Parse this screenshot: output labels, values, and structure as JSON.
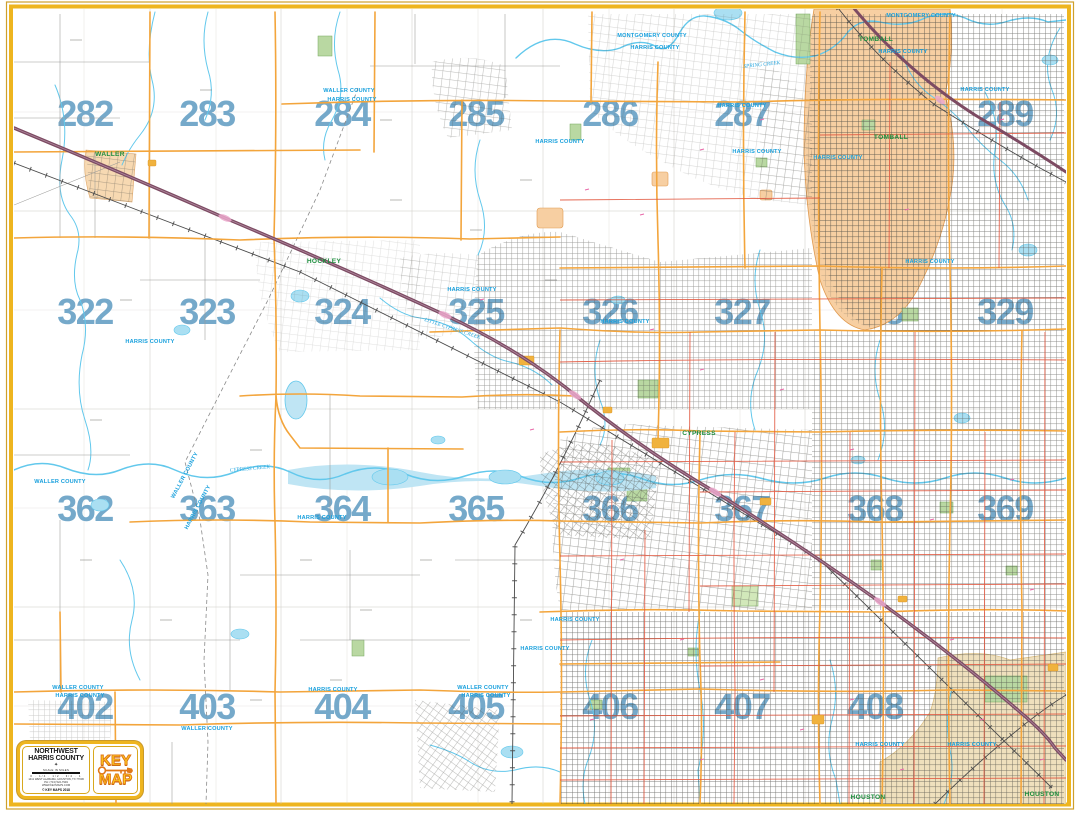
{
  "map": {
    "grid_numbers": [
      {
        "t": "282",
        "x": 85,
        "y": 126
      },
      {
        "t": "283",
        "x": 207,
        "y": 126
      },
      {
        "t": "284",
        "x": 342,
        "y": 126
      },
      {
        "t": "285",
        "x": 476,
        "y": 126
      },
      {
        "t": "286",
        "x": 610,
        "y": 126
      },
      {
        "t": "287",
        "x": 742,
        "y": 126
      },
      {
        "t": "288",
        "x": 875,
        "y": 126
      },
      {
        "t": "289",
        "x": 1005,
        "y": 126
      },
      {
        "t": "322",
        "x": 85,
        "y": 324
      },
      {
        "t": "323",
        "x": 207,
        "y": 324
      },
      {
        "t": "324",
        "x": 342,
        "y": 324
      },
      {
        "t": "325",
        "x": 476,
        "y": 324
      },
      {
        "t": "326",
        "x": 610,
        "y": 324
      },
      {
        "t": "327",
        "x": 742,
        "y": 324
      },
      {
        "t": "328",
        "x": 875,
        "y": 324
      },
      {
        "t": "329",
        "x": 1005,
        "y": 324
      },
      {
        "t": "362",
        "x": 85,
        "y": 521
      },
      {
        "t": "363",
        "x": 207,
        "y": 521
      },
      {
        "t": "364",
        "x": 342,
        "y": 521
      },
      {
        "t": "365",
        "x": 476,
        "y": 521
      },
      {
        "t": "366",
        "x": 610,
        "y": 521
      },
      {
        "t": "367",
        "x": 742,
        "y": 521
      },
      {
        "t": "368",
        "x": 875,
        "y": 521
      },
      {
        "t": "369",
        "x": 1005,
        "y": 521
      },
      {
        "t": "402",
        "x": 85,
        "y": 719
      },
      {
        "t": "403",
        "x": 207,
        "y": 719
      },
      {
        "t": "404",
        "x": 342,
        "y": 719
      },
      {
        "t": "405",
        "x": 476,
        "y": 719
      },
      {
        "t": "406",
        "x": 610,
        "y": 719
      },
      {
        "t": "407",
        "x": 742,
        "y": 719
      },
      {
        "t": "408",
        "x": 875,
        "y": 719
      },
      {
        "t": "409",
        "x": 1005,
        "y": 719
      }
    ],
    "county_labels": [
      {
        "t": "WALLER COUNTY",
        "x": 349,
        "y": 92
      },
      {
        "t": "HARRIS COUNTY",
        "x": 352,
        "y": 101
      },
      {
        "t": "MONTGOMERY COUNTY",
        "x": 652,
        "y": 37
      },
      {
        "t": "HARRIS COUNTY",
        "x": 655,
        "y": 49
      },
      {
        "t": "MONTGOMERY COUNTY",
        "x": 921,
        "y": 17
      },
      {
        "t": "HARRIS COUNTY",
        "x": 903,
        "y": 53
      },
      {
        "t": "HARRIS COUNTY",
        "x": 742,
        "y": 107
      },
      {
        "t": "HARRIS COUNTY",
        "x": 757,
        "y": 153
      },
      {
        "t": "HARRIS COUNTY",
        "x": 985,
        "y": 91
      },
      {
        "t": "HARRIS COUNTY",
        "x": 838,
        "y": 159
      },
      {
        "t": "HARRIS COUNTY",
        "x": 560,
        "y": 143
      },
      {
        "t": "HARRIS COUNTY",
        "x": 472,
        "y": 291
      },
      {
        "t": "HARRIS COUNTY",
        "x": 625,
        "y": 323
      },
      {
        "t": "HARRIS COUNTY",
        "x": 150,
        "y": 343
      },
      {
        "t": "WALLER COUNTY",
        "x": 60,
        "y": 483
      },
      {
        "t": "WALLER COUNTY",
        "x": 186,
        "y": 476,
        "r": -62
      },
      {
        "t": "HARRIS COUNTY",
        "x": 199,
        "y": 508,
        "r": -62
      },
      {
        "t": "HARRIS COUNTY",
        "x": 322,
        "y": 519
      },
      {
        "t": "HARRIS COUNTY",
        "x": 545,
        "y": 650
      },
      {
        "t": "HARRIS COUNTY",
        "x": 575,
        "y": 621
      },
      {
        "t": "WALLER COUNTY",
        "x": 78,
        "y": 689
      },
      {
        "t": "HARRIS COUNTY",
        "x": 80,
        "y": 697
      },
      {
        "t": "WALLER COUNTY",
        "x": 207,
        "y": 730
      },
      {
        "t": "HARRIS COUNTY",
        "x": 333,
        "y": 691
      },
      {
        "t": "WALLER COUNTY",
        "x": 483,
        "y": 689
      },
      {
        "t": "HARRIS COUNTY",
        "x": 486,
        "y": 697
      },
      {
        "t": "HARRIS COUNTY",
        "x": 880,
        "y": 746
      },
      {
        "t": "HARRIS COUNTY",
        "x": 972,
        "y": 746
      },
      {
        "t": "HARRIS COUNTY",
        "x": 930,
        "y": 263
      }
    ],
    "town_labels": [
      {
        "t": "WALLER",
        "x": 110,
        "y": 156
      },
      {
        "t": "HOCKLEY",
        "x": 324,
        "y": 263
      },
      {
        "t": "TOMBALL",
        "x": 876,
        "y": 41
      },
      {
        "t": "TOMBALL",
        "x": 891,
        "y": 139
      },
      {
        "t": "CYPRESS",
        "x": 699,
        "y": 435
      },
      {
        "t": "HOUSTON",
        "x": 868,
        "y": 799
      },
      {
        "t": "HOUSTON",
        "x": 1042,
        "y": 796
      }
    ],
    "creek_labels": [
      {
        "t": "SPRING CREEK",
        "x": 762,
        "y": 66,
        "r": -6
      },
      {
        "t": "CYPRESS CREEK",
        "x": 250,
        "y": 470,
        "r": -5
      },
      {
        "t": "LITTLE CYPRESS CREEK",
        "x": 452,
        "y": 330,
        "r": 18
      }
    ],
    "colors": {
      "grid_number": "#6aa2c6",
      "arterial_orange": "#f3a53c",
      "freeway_maroon": "#7d4b63",
      "secondary_red": "#e25840",
      "water_blue": "#62c8ec",
      "county_text": "#18a0dd",
      "town_text": "#1e8f3e",
      "city_fill_tomball": "#f7cfa2",
      "city_fill_houston": "#efe0bd",
      "park_green": "#b9d8a2",
      "frame_gold": "#eeb51f"
    }
  },
  "legend": {
    "region_line1": "NORTHWEST",
    "region_line2": "HARRIS COUNTY",
    "compass_glyph": "✦",
    "scale_title": "SCALE IN MILES",
    "scale_ticks": "0 · 1/4 · 1/2 · 3/4 · 1",
    "address": "1411 WEST ALABAMA, HOUSTON, TX 77006",
    "phone": "PH: (713) 522-7949",
    "website": "WWW.KEYMAPS.COM",
    "copyright": "© KEY MAPS 2018",
    "logo_word1": "KEY",
    "logo_word2": "MAP"
  }
}
